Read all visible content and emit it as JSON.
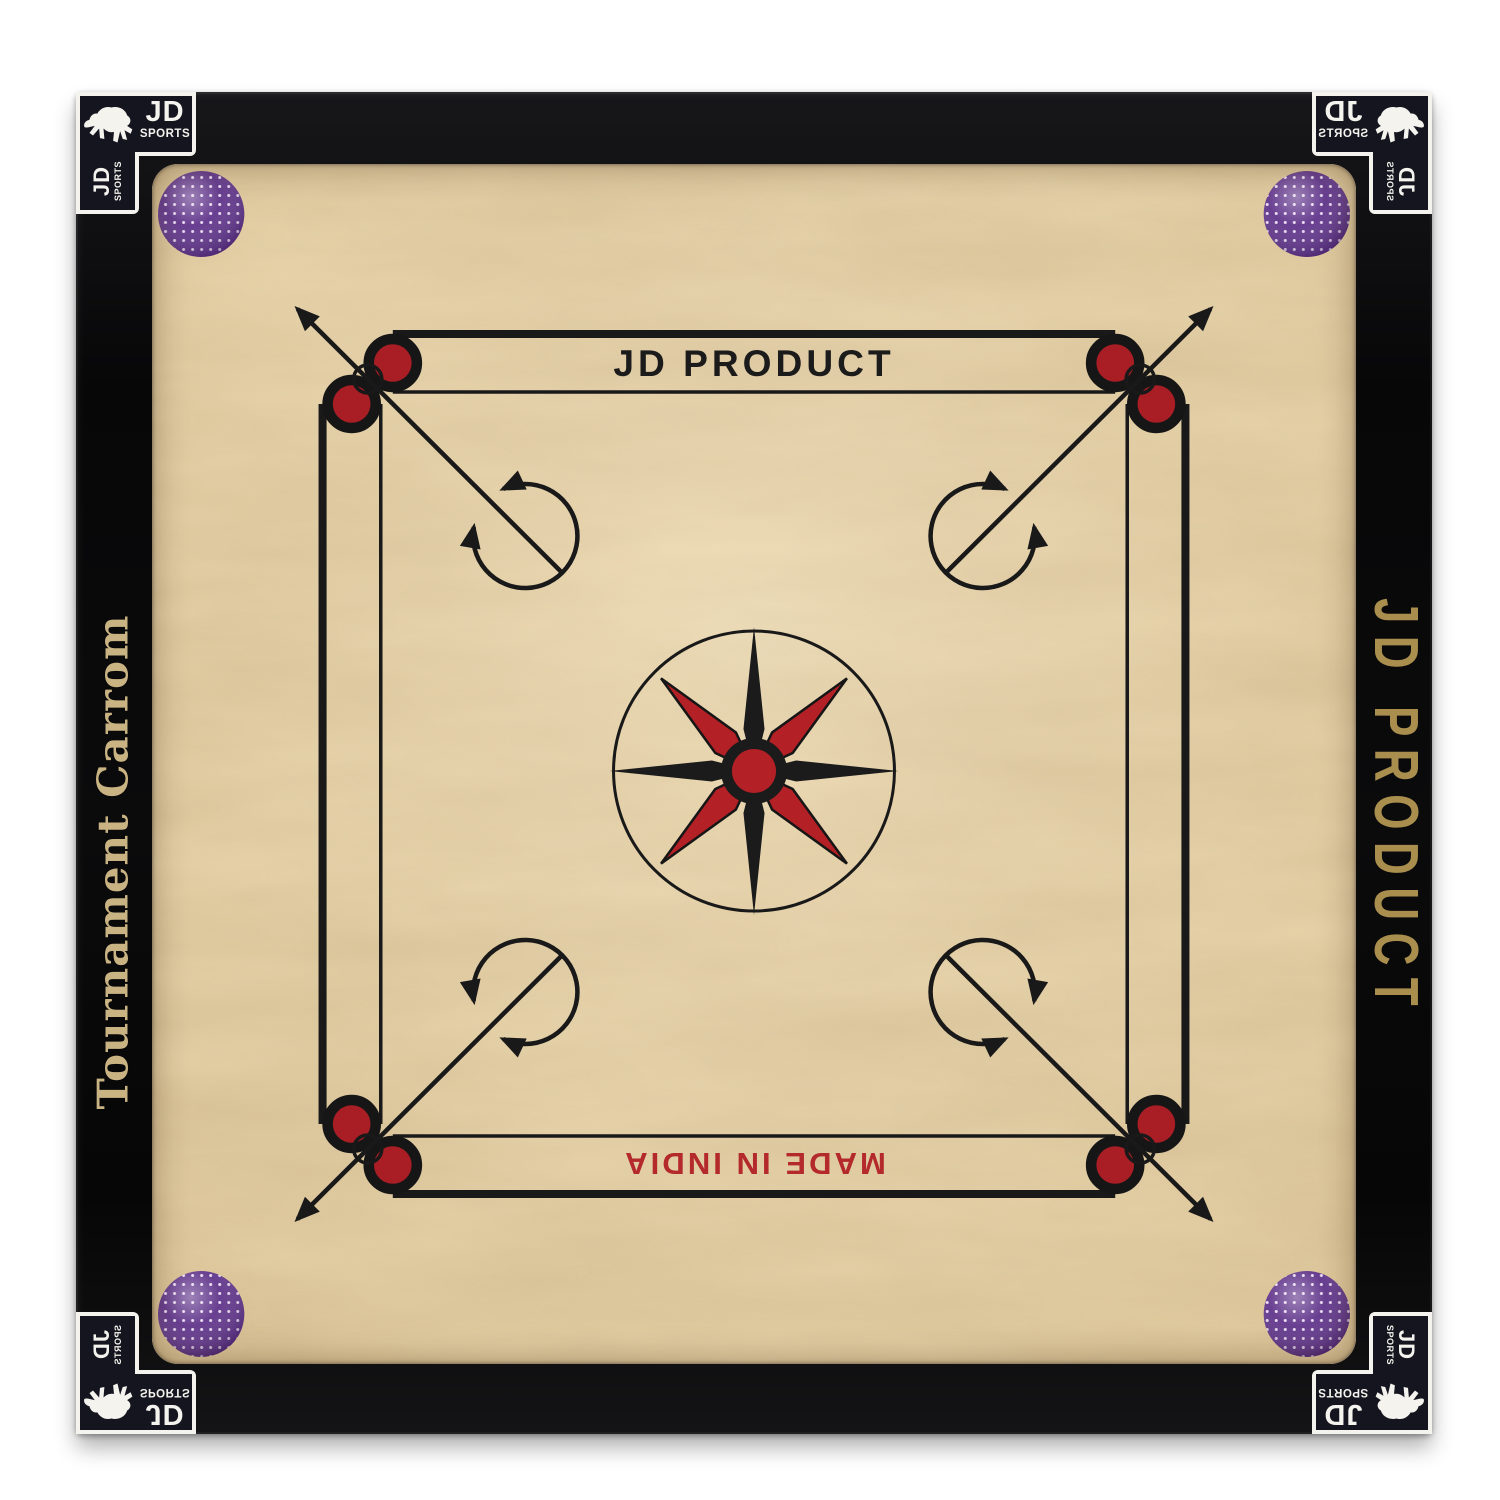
{
  "frame": {
    "left_rail_text": "Tournament Carrom",
    "right_rail_text": "JD PRODUCT",
    "rail_gold_color": "#c9b383",
    "frame_color": "#0a0a0b",
    "corner_logo": {
      "brand": "JD",
      "sub": "SPORTS",
      "icon": "leaping-horse",
      "label_bg_color": "#15151f",
      "label_border_color": "#f4f3ee"
    }
  },
  "board": {
    "top_label": "JD PRODUCT",
    "bottom_label": "MADE IN INDIA",
    "wood_color": "#e9d5ac",
    "line_color": "#191919",
    "accent_red": "#a81e24",
    "bottom_label_color": "#b3292c",
    "pocket_color": "#5b2e87",
    "center_motif": "eight-point-compass-star",
    "corner_motif": "rotation-circle-with-arrows",
    "pocket_count": 4,
    "baseline_circle_count": 8
  }
}
